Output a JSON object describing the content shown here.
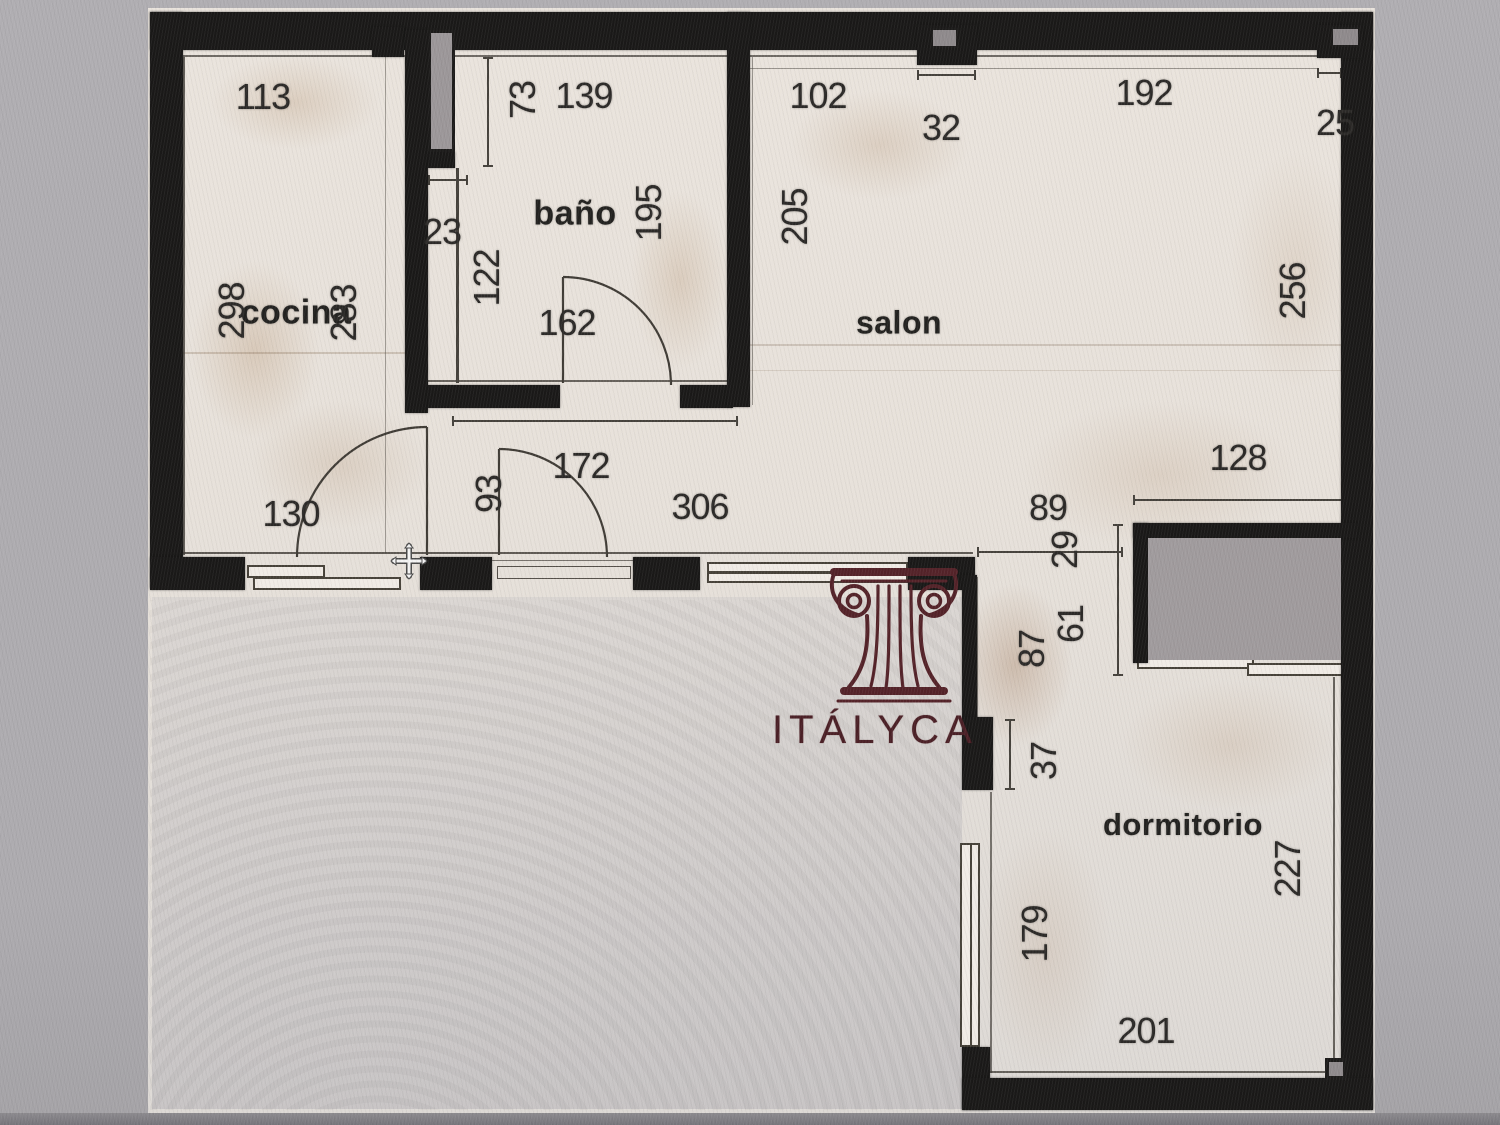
{
  "brand": {
    "name": "ITÁLYCA"
  },
  "rooms": {
    "kitchen": "cocina",
    "bathroom": "baño",
    "living": "salon",
    "bedroom": "dormitorio"
  },
  "dimensions": [
    {
      "v": "113",
      "x": 263,
      "y": 97,
      "rot": false
    },
    {
      "v": "73",
      "x": 523,
      "y": 100,
      "rot": true
    },
    {
      "v": "139",
      "x": 584,
      "y": 96,
      "rot": false
    },
    {
      "v": "102",
      "x": 818,
      "y": 96,
      "rot": false
    },
    {
      "v": "32",
      "x": 941,
      "y": 128,
      "rot": false
    },
    {
      "v": "192",
      "x": 1144,
      "y": 93,
      "rot": false
    },
    {
      "v": "25",
      "x": 1335,
      "y": 123,
      "rot": false
    },
    {
      "v": "23",
      "x": 442,
      "y": 232,
      "rot": false
    },
    {
      "v": "195",
      "x": 649,
      "y": 213,
      "rot": true
    },
    {
      "v": "205",
      "x": 795,
      "y": 217,
      "rot": true
    },
    {
      "v": "256",
      "x": 1293,
      "y": 291,
      "rot": true
    },
    {
      "v": "298",
      "x": 232,
      "y": 311,
      "rot": true
    },
    {
      "v": "283",
      "x": 344,
      "y": 313,
      "rot": true
    },
    {
      "v": "122",
      "x": 487,
      "y": 278,
      "rot": true
    },
    {
      "v": "162",
      "x": 567,
      "y": 323,
      "rot": false
    },
    {
      "v": "130",
      "x": 291,
      "y": 514,
      "rot": false
    },
    {
      "v": "93",
      "x": 489,
      "y": 494,
      "rot": true
    },
    {
      "v": "172",
      "x": 581,
      "y": 466,
      "rot": false
    },
    {
      "v": "306",
      "x": 700,
      "y": 507,
      "rot": false
    },
    {
      "v": "128",
      "x": 1238,
      "y": 458,
      "rot": false
    },
    {
      "v": "89",
      "x": 1048,
      "y": 508,
      "rot": false
    },
    {
      "v": "29",
      "x": 1065,
      "y": 550,
      "rot": true
    },
    {
      "v": "61",
      "x": 1071,
      "y": 624,
      "rot": true
    },
    {
      "v": "87",
      "x": 1032,
      "y": 649,
      "rot": true
    },
    {
      "v": "37",
      "x": 1044,
      "y": 761,
      "rot": true
    },
    {
      "v": "227",
      "x": 1288,
      "y": 869,
      "rot": true
    },
    {
      "v": "179",
      "x": 1035,
      "y": 934,
      "rot": true
    },
    {
      "v": "201",
      "x": 1146,
      "y": 1031,
      "rot": false
    }
  ]
}
